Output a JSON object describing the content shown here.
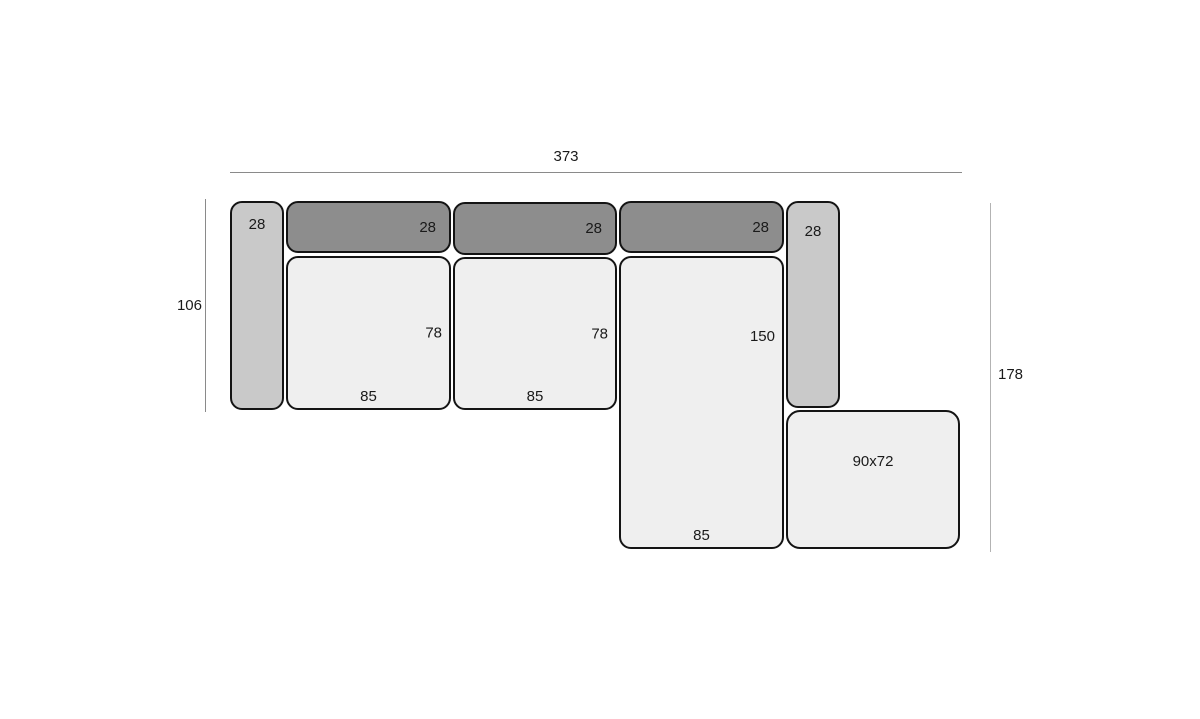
{
  "dimensions": {
    "total_width": "373",
    "left_depth": "106",
    "right_depth": "178"
  },
  "pieces": {
    "left_armrest": {
      "width_label": "28"
    },
    "backrest_1": {
      "width_label": "28"
    },
    "backrest_2": {
      "width_label": "28"
    },
    "backrest_3": {
      "width_label": "28"
    },
    "right_armrest": {
      "width_label": "28"
    },
    "seat_1": {
      "depth_label": "78",
      "width_label": "85"
    },
    "seat_2": {
      "depth_label": "78",
      "width_label": "85"
    },
    "chaise": {
      "depth_label": "150",
      "width_label": "85"
    },
    "ottoman": {
      "size_label": "90x72"
    }
  },
  "colors": {
    "bg": "#ffffff",
    "outline": "#141414",
    "armrest_fill": "#c9c9c9",
    "backrest_fill": "#8d8d8d",
    "seat_fill": "#efefef",
    "dim_line": "#8a8a8a",
    "dim_line_light": "#b3b3b3",
    "text": "#1a1a1a"
  }
}
